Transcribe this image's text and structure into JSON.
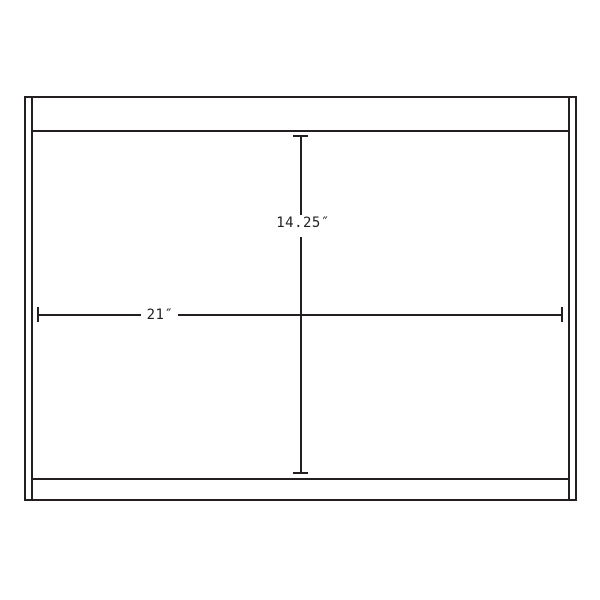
{
  "diagram": {
    "type": "technical-dimension-drawing",
    "background_color": "#ffffff",
    "line_color": "#231f20",
    "dimensions": {
      "height": {
        "label": "14.25″",
        "value": 14.25,
        "unit": "in"
      },
      "width": {
        "label": "21″",
        "value": 21,
        "unit": "in"
      }
    }
  }
}
